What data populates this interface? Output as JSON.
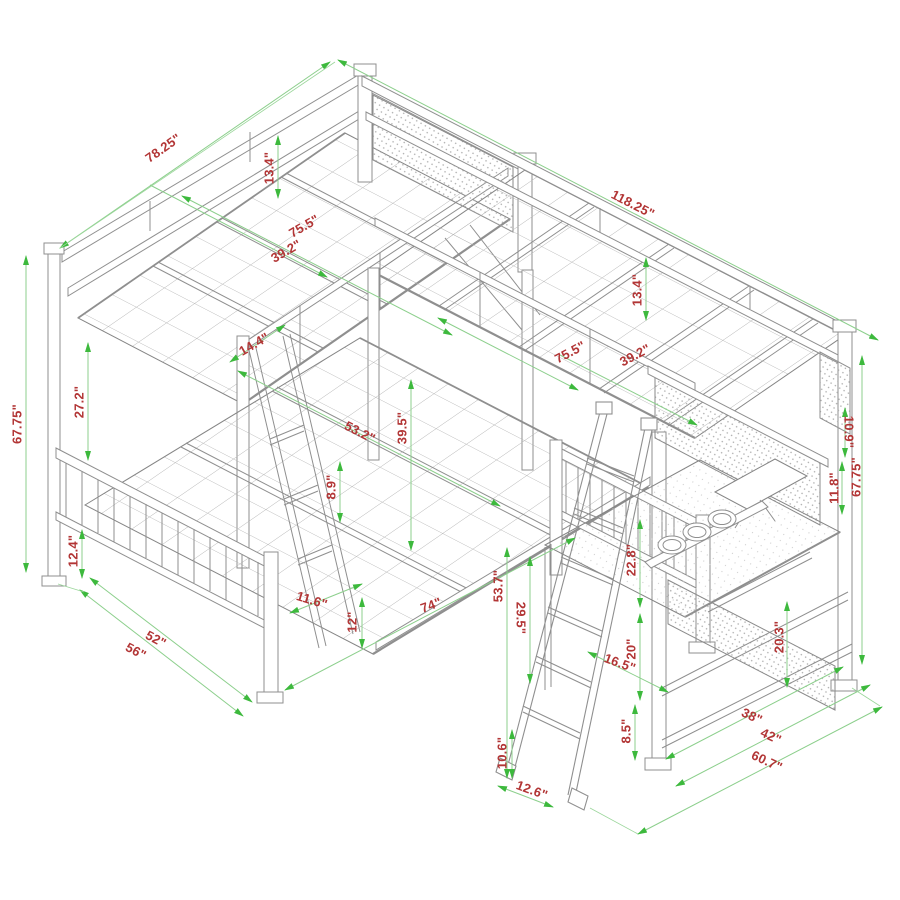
{
  "drawing": {
    "type": "isometric technical line drawing",
    "subject": "L-shaped triple bunk bed: twin-over-full bunk with twin loft bed over workstation desk and angled ladder",
    "units": "inches"
  },
  "colors": {
    "background": "#ffffff",
    "line_art": "#8f8f8f",
    "dimension_line": "#8ccf8c",
    "dimension_arrow": "#3db93d",
    "dimension_text": "#b23535"
  },
  "dims": [
    {
      "label": "78.25\""
    },
    {
      "label": "13.4\""
    },
    {
      "label": "75.5\""
    },
    {
      "label": "39.2\""
    },
    {
      "label": "118.25\""
    },
    {
      "label": "13.4\""
    },
    {
      "label": "75.5\""
    },
    {
      "label": "39.2\""
    },
    {
      "label": "14.4\""
    },
    {
      "label": "67.75\""
    },
    {
      "label": "27.2\""
    },
    {
      "label": "12.4\""
    },
    {
      "label": "56\""
    },
    {
      "label": "52\""
    },
    {
      "label": "11.6\""
    },
    {
      "label": "12\""
    },
    {
      "label": "74\""
    },
    {
      "label": "53.2\""
    },
    {
      "label": "39.5\""
    },
    {
      "label": "8.9\""
    },
    {
      "label": "53.7\""
    },
    {
      "label": "29.5\""
    },
    {
      "label": "22.8\""
    },
    {
      "label": "20\""
    },
    {
      "label": "16.5\""
    },
    {
      "label": "8.5\""
    },
    {
      "label": "10.6\""
    },
    {
      "label": "12.6\""
    },
    {
      "label": "10.9\""
    },
    {
      "label": "11.8\""
    },
    {
      "label": "67.75\""
    },
    {
      "label": "20.3\""
    },
    {
      "label": "38\""
    },
    {
      "label": "42\""
    },
    {
      "label": "60.7\""
    }
  ]
}
